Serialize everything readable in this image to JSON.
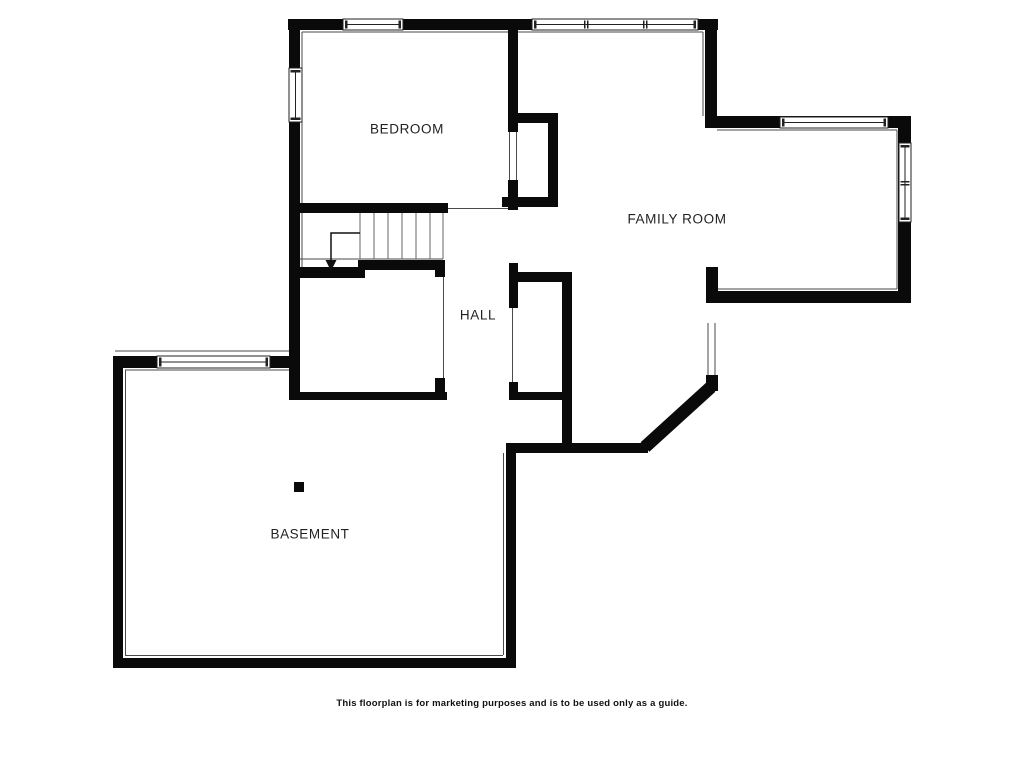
{
  "canvas": {
    "width": 1024,
    "height": 768,
    "background": "#ffffff"
  },
  "colors": {
    "wall": "#0a0a0a",
    "thin_line": "#4a4a4a",
    "stair_line": "#666666",
    "window_fill": "#ffffff",
    "window_outline": "#222222",
    "label_text": "#222222",
    "arrow": "#111111"
  },
  "rooms": [
    {
      "id": "bedroom",
      "name": "BEDROOM",
      "x": 407,
      "y": 129
    },
    {
      "id": "family",
      "name": "FAMILY ROOM",
      "x": 677,
      "y": 219
    },
    {
      "id": "hall",
      "name": "HALL",
      "x": 478,
      "y": 315
    },
    {
      "id": "basement",
      "name": "BASEMENT",
      "x": 310,
      "y": 534
    }
  ],
  "disclaimer": "This floorplan is for marketing purposes and is to be used only as a guide.",
  "floorplan": {
    "walls": [
      {
        "x": 288,
        "y": 19,
        "w": 430,
        "h": 11
      },
      {
        "x": 289,
        "y": 19,
        "w": 11,
        "h": 381
      },
      {
        "x": 705,
        "y": 19,
        "w": 12,
        "h": 108
      },
      {
        "x": 705,
        "y": 116,
        "w": 205,
        "h": 12
      },
      {
        "x": 898,
        "y": 116,
        "w": 13,
        "h": 187
      },
      {
        "x": 713,
        "y": 291,
        "w": 197,
        "h": 12
      },
      {
        "x": 706,
        "y": 267,
        "w": 12,
        "h": 36
      },
      {
        "x": 706,
        "y": 375,
        "w": 12,
        "h": 16
      },
      {
        "x": 508,
        "y": 443,
        "w": 140,
        "h": 10
      },
      {
        "x": 506,
        "y": 443,
        "w": 10,
        "h": 225
      },
      {
        "x": 113,
        "y": 658,
        "w": 403,
        "h": 10
      },
      {
        "x": 113,
        "y": 357,
        "w": 10,
        "h": 311
      },
      {
        "x": 113,
        "y": 356,
        "w": 184,
        "h": 12
      },
      {
        "x": 508,
        "y": 19,
        "w": 10,
        "h": 113
      },
      {
        "x": 508,
        "y": 180,
        "w": 10,
        "h": 30
      },
      {
        "x": 515,
        "y": 113,
        "w": 43,
        "h": 10
      },
      {
        "x": 548,
        "y": 113,
        "w": 10,
        "h": 94
      },
      {
        "x": 502,
        "y": 197,
        "w": 56,
        "h": 10
      },
      {
        "x": 289,
        "y": 203,
        "w": 159,
        "h": 10
      },
      {
        "x": 509,
        "y": 263,
        "w": 9,
        "h": 45
      },
      {
        "x": 515,
        "y": 272,
        "w": 55,
        "h": 10
      },
      {
        "x": 562,
        "y": 272,
        "w": 10,
        "h": 181
      },
      {
        "x": 509,
        "y": 382,
        "w": 9,
        "h": 18
      },
      {
        "x": 509,
        "y": 392,
        "w": 53,
        "h": 8
      },
      {
        "x": 435,
        "y": 260,
        "w": 10,
        "h": 17
      },
      {
        "x": 358,
        "y": 260,
        "w": 87,
        "h": 10
      },
      {
        "x": 289,
        "y": 267,
        "w": 76,
        "h": 11
      },
      {
        "x": 435,
        "y": 378,
        "w": 10,
        "h": 22
      },
      {
        "x": 292,
        "y": 392,
        "w": 155,
        "h": 8
      }
    ],
    "diagonal_walls": [
      {
        "x1": 645,
        "y1": 447,
        "x2": 711,
        "y2": 387,
        "width": 13
      }
    ],
    "thin_lines": [
      {
        "x1": 302,
        "y1": 32,
        "x2": 703,
        "y2": 32
      },
      {
        "x1": 302,
        "y1": 32,
        "x2": 302,
        "y2": 203
      },
      {
        "x1": 703,
        "y1": 32,
        "x2": 703,
        "y2": 116
      },
      {
        "x1": 717,
        "y1": 130,
        "x2": 897,
        "y2": 130
      },
      {
        "x1": 897,
        "y1": 130,
        "x2": 897,
        "y2": 289
      },
      {
        "x1": 718,
        "y1": 289,
        "x2": 897,
        "y2": 289
      },
      {
        "x1": 708,
        "y1": 323,
        "x2": 708,
        "y2": 375
      },
      {
        "x1": 715,
        "y1": 323,
        "x2": 715,
        "y2": 375
      },
      {
        "x1": 443.5,
        "y1": 277,
        "x2": 443.5,
        "y2": 378
      },
      {
        "x1": 512.5,
        "y1": 308,
        "x2": 512.5,
        "y2": 388
      },
      {
        "x1": 298,
        "y1": 259,
        "x2": 443,
        "y2": 259
      },
      {
        "x1": 448,
        "y1": 208.5,
        "x2": 508,
        "y2": 208.5
      },
      {
        "x1": 125,
        "y1": 370,
        "x2": 290,
        "y2": 370
      },
      {
        "x1": 125.5,
        "y1": 370,
        "x2": 125.5,
        "y2": 655
      },
      {
        "x1": 125,
        "y1": 655.5,
        "x2": 503,
        "y2": 655.5
      },
      {
        "x1": 503.5,
        "y1": 453,
        "x2": 503.5,
        "y2": 655
      },
      {
        "x1": 115,
        "y1": 351,
        "x2": 298,
        "y2": 351
      },
      {
        "x1": 302,
        "y1": 213,
        "x2": 302,
        "y2": 267
      },
      {
        "x1": 509.5,
        "y1": 132,
        "x2": 509.5,
        "y2": 180
      },
      {
        "x1": 516.5,
        "y1": 132,
        "x2": 516.5,
        "y2": 180
      }
    ],
    "windows": [
      {
        "x": 343,
        "y": 19,
        "w": 60,
        "h": 11,
        "orient": "h",
        "mullions": []
      },
      {
        "x": 532,
        "y": 19,
        "w": 166,
        "h": 11,
        "orient": "h",
        "mullions": [
          52,
          111
        ]
      },
      {
        "x": 289,
        "y": 68,
        "w": 13,
        "h": 54,
        "orient": "v",
        "mullions": []
      },
      {
        "x": 780,
        "y": 117,
        "w": 108,
        "h": 11,
        "orient": "h",
        "mullions": []
      },
      {
        "x": 899,
        "y": 143,
        "w": 12,
        "h": 79,
        "orient": "v",
        "mullions": [
          38
        ]
      },
      {
        "x": 157,
        "y": 356,
        "w": 113,
        "h": 12,
        "orient": "h",
        "mullions": []
      }
    ],
    "stairs": {
      "tread_xs": [
        360,
        374,
        388,
        402,
        416,
        430,
        443
      ],
      "y1": 213,
      "y2": 259
    },
    "down_arrow": {
      "path": [
        [
          360,
          233
        ],
        [
          331,
          233
        ],
        [
          331,
          262
        ]
      ],
      "head": [
        [
          331,
          271
        ],
        [
          325.5,
          260
        ],
        [
          336.5,
          260
        ]
      ]
    },
    "support_post": {
      "x": 294,
      "y": 482,
      "w": 10,
      "h": 10
    }
  }
}
